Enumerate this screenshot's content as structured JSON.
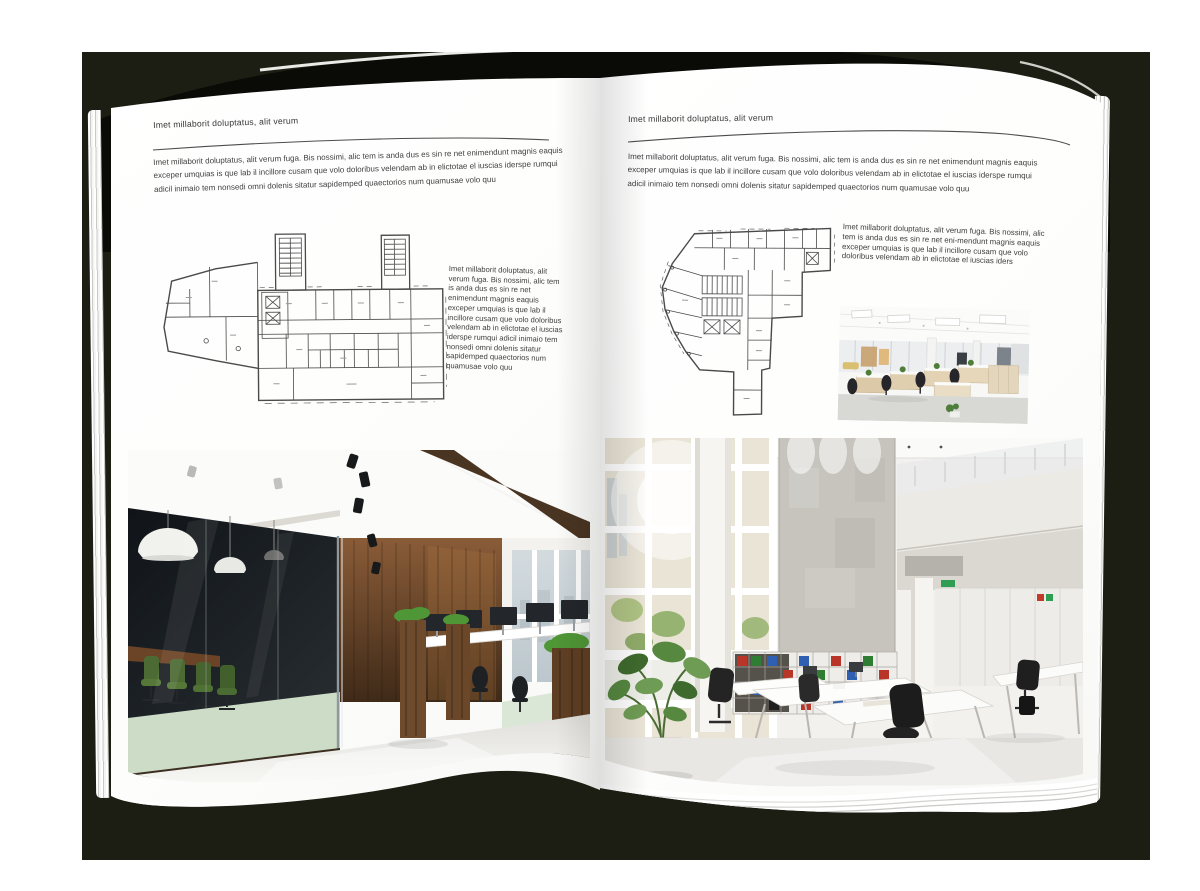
{
  "palette": {
    "backdrop": "#1d1e13",
    "cover": "#0a0b06",
    "page": "#ffffff",
    "text": "#3e3e3e",
    "plan_line": "#4a4a4a",
    "wood_dark": "#4a3522",
    "wood_mid": "#7a5233",
    "chair_green": "#4c6a33",
    "plant_green": "#4f7d3a",
    "floor_light": "#e9e8e5"
  },
  "left_page": {
    "header": "Imet millaborit doluptatus, alit verum",
    "intro": "Imet millaborit doluptatus, alit verum fuga. Bis nossimi, alic tem is anda dus es sin re net enimendunt magnis eaquis exceper umquias is que lab il incillore cusam que volo doloribus velendam ab in elictotae el iuscias iderspe rumqui adicil inimaio tem nonsedi omni dolenis sitatur sapidemped quaectorios num quamusae volo quu",
    "column_text": "Imet millaborit doluptatus, alit verum fuga. Bis nossimi, alic tem is anda dus es sin re net enimendunt magnis eaquis exceper umquias is que lab il incillore cusam que volo doloribus velendam ab in elictotae el iuscias iderspe rumqui adicil inimaio tem nonsedi omni dolenis sitatur sapidemped quaectorios num quamusae volo quu",
    "floorplan_name": "floor-plan-wide-building",
    "photo_name": "office-photo-dark-wood-glass-meeting-room"
  },
  "right_page": {
    "header": "Imet millaborit doluptatus, alit verum",
    "intro": "Imet millaborit doluptatus, alit verum fuga. Bis nossimi, alic tem is anda dus es sin re net enimendunt magnis eaquis exceper umquias is que lab il incillore cusam que volo doloribus velendam ab in elictotae el iuscias iderspe rumqui adicil inimaio tem nonsedi omni dolenis sitatur sapidemped quaectorios num quamusae volo quu",
    "column_text": "Imet millaborit doluptatus, alit verum fuga. Bis nossimi, alic tem is anda dus es sin re net eni-mendunt magnis eaquis exceper umquias is que lab il incillore cusam que volo doloribus velendam ab in elictotae el iuscias iders",
    "floorplan_name": "floor-plan-angled-building",
    "photo_small_name": "office-photo-open-plan-cubicles",
    "photo_large_name": "office-photo-white-atrium"
  }
}
